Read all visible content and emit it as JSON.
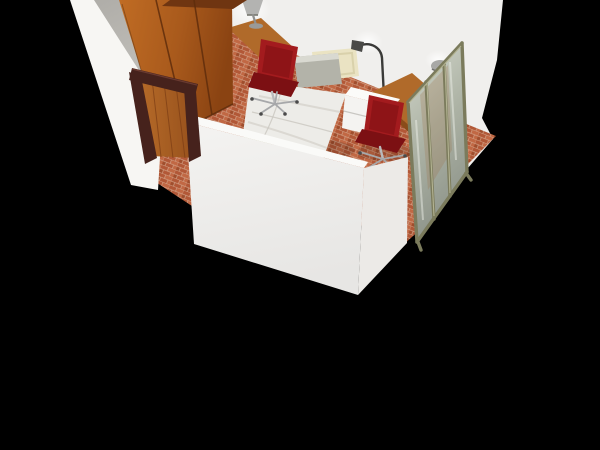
{
  "scene": {
    "view": "3d-room-render",
    "room_label": "bedroom",
    "background_color": "#000000"
  },
  "colors": {
    "background": "#000000",
    "wall_white": "#f0efed",
    "wall_white_outer": "#f7f6f3",
    "wall_gray": "#b6b4af",
    "wall_front_face": "#f3f2f0",
    "wall_front_top": "#fafaf8",
    "wall_se_face": "#eceae7",
    "floor_mortar": "#d2a085",
    "floor_brick_a": "#b25837",
    "floor_brick_b": "#c16844",
    "floor_brick_c": "#a04e2d",
    "wardrobe_wood": "#b2611f",
    "wardrobe_top": "#6f3511",
    "door_frame": "#46221c",
    "door_frame_light": "#653630",
    "door_panel": "#a85d22",
    "desk_wood": "#b06a2a",
    "desk_wood_dark": "#8a4c1a",
    "bed_duvet": "#edece8",
    "bed_base": "#c6c39c",
    "headboard": "#eae3c3",
    "pillow": "#b3b3a9",
    "pillow_light": "#d9d9d1",
    "nightstand": "#f4f3f1",
    "nightstand_top": "#fbfbf9",
    "chair_red": "#a31b1e",
    "chair_red_dark": "#7c1013",
    "chrome": "#b9babc",
    "lamp_silver": "#b3b3b1",
    "lamp_dark": "#3a3a38",
    "mirror_frame": "#83836a",
    "mirror_glass": "#c3c8bd",
    "glow": "#ffffff"
  },
  "objects": [
    {
      "name": "white-walls",
      "description": "room walls, white outside, one gray interior wall"
    },
    {
      "name": "brick-floor",
      "description": "terracotta brick tile floor"
    },
    {
      "name": "wardrobe",
      "description": "three-door wooden wardrobe against gray wall"
    },
    {
      "name": "entry-door",
      "description": "open wooden door with dark brown frame"
    },
    {
      "name": "desk-left",
      "description": "wooden wall desk with silver table lamp"
    },
    {
      "name": "office-chair-left",
      "description": "red swivel office chair at left desk"
    },
    {
      "name": "single-bed",
      "description": "single bed, white duvet, gray pillow, cream headboard, green base"
    },
    {
      "name": "floor-lamp",
      "description": "black arc floor lamp behind headboard"
    },
    {
      "name": "nightstand",
      "description": "white two-drawer nightstand beside bed"
    },
    {
      "name": "desk-right",
      "description": "wooden desk with white drawer pedestal and silver lamp"
    },
    {
      "name": "office-chair-right",
      "description": "red swivel office chair at right desk"
    },
    {
      "name": "mirror-screen",
      "description": "folding mirror room divider with bronze frame"
    }
  ]
}
